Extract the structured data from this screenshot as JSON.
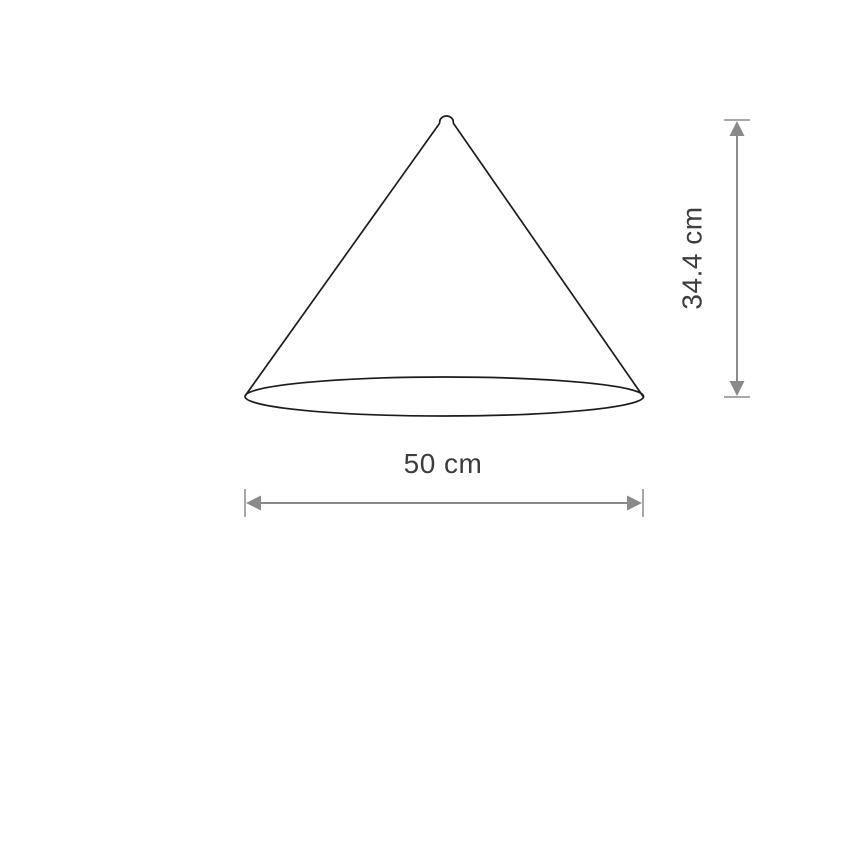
{
  "diagram": {
    "type": "product-dimension-drawing",
    "subject": "cone-lampshade",
    "background_color": "#ffffff",
    "outline_color": "#1c1c1c",
    "dimension_line_color": "#8a8a8a",
    "dimension_cap_color": "#a8a8a8",
    "label_color": "#3d3d3d",
    "dimensions": {
      "height": {
        "label": "34.4 cm",
        "value": 34.4,
        "unit": "cm",
        "orientation": "vertical"
      },
      "width": {
        "label": "50 cm",
        "value": 50,
        "unit": "cm",
        "orientation": "horizontal"
      }
    }
  }
}
